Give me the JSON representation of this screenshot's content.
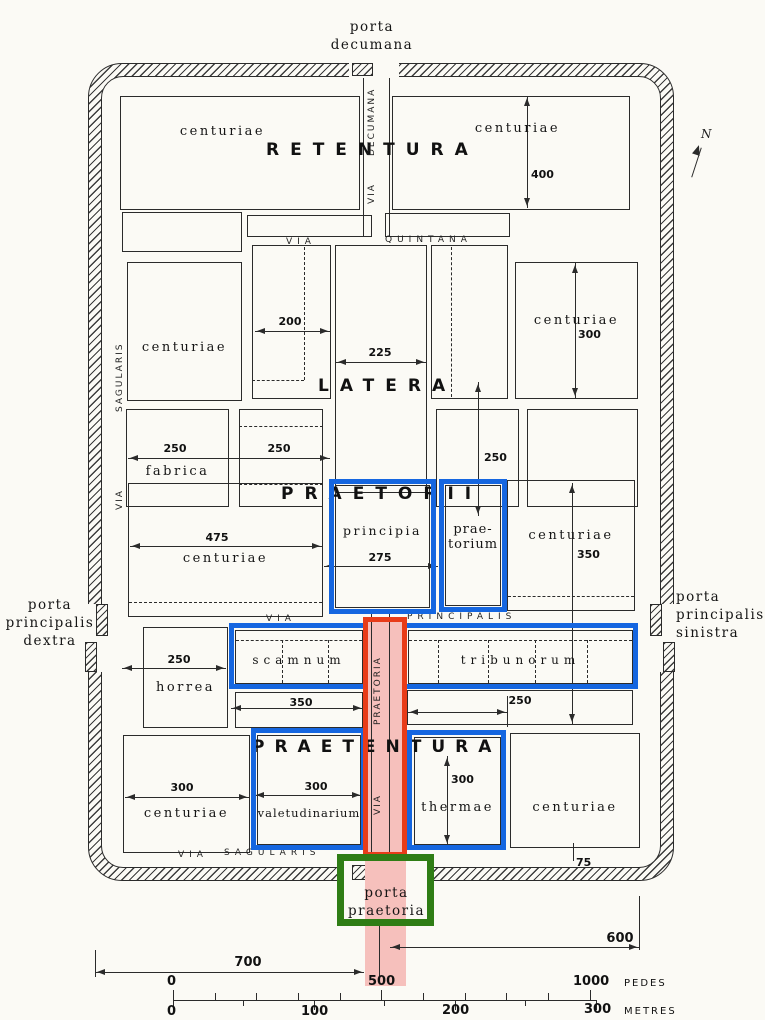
{
  "canvas": {
    "bg": "#fbfaf5"
  },
  "colors": {
    "ink": "#2b2b2b",
    "blue": "#1566e0",
    "red": "#e83c19",
    "green": "#2f7d15",
    "pink": "#f6c0bc"
  },
  "compass": {
    "north": "N"
  },
  "gates": {
    "decumana": {
      "l1": "porta",
      "l2": "decumana"
    },
    "dextra": {
      "l1": "porta",
      "l2": "principalis",
      "l3": "dextra"
    },
    "sinistra": {
      "l1": "porta",
      "l2": "principalis",
      "l3": "sinistra"
    },
    "praetoria": {
      "l1": "porta",
      "l2": "praetoria"
    }
  },
  "sections": {
    "retentura": "RETENTURA",
    "latera": "LATERA",
    "praetorii": "PRAETORII",
    "praetentura": "PRAETENTURA"
  },
  "roads": {
    "decumana": {
      "via": "VIA",
      "name": "DECUMANA"
    },
    "quintana": {
      "via": "VIA",
      "name": "QUINTANA"
    },
    "principalis": {
      "via": "VIA",
      "name": "PRINCIPALIS"
    },
    "praetoria": {
      "via": "VIA",
      "name": "PRAETORIA"
    },
    "sagularis_left": {
      "via": "VIA",
      "name": "SAGULARIS"
    },
    "sagularis_bottom": {
      "via": "VIA",
      "name": "SAGULARIS"
    }
  },
  "buildings": {
    "retentura_centuriae_left": "centuriae",
    "retentura_centuriae_right": "centuriae",
    "latera_centuriae_left": "centuriae",
    "latera_centuriae_right": "centuriae",
    "fabrica": "fabrica",
    "praetorii_centuriae_left": "centuriae",
    "principia": "principia",
    "praetorium_l1": "prae-",
    "praetorium_l2": "torium",
    "praetorii_centuriae_right": "centuriae",
    "horrea": "horrea",
    "scamnum": "scamnum",
    "tribunorum": "tribunorum",
    "praetentura_centuriae_left": "centuriae",
    "valetudinarium": "valetudinarium",
    "thermae": "thermae",
    "praetentura_centuriae_right": "centuriae"
  },
  "dims": {
    "retentura_400": "400",
    "latera_200": "200",
    "latera_225": "225",
    "latera_300": "300",
    "fabrica_250": "250",
    "latera_mid_250": "250",
    "latera_right_250": "250",
    "centuriae_475": "475",
    "principia_275": "275",
    "centuriae_350": "350",
    "horrea_250": "250",
    "scamnum_350": "350",
    "tribunorum_250": "250",
    "praetentura_300_left": "300",
    "valetudinarium_300": "300",
    "thermae_300": "300",
    "rampart_75": "75",
    "south_600": "600",
    "south_700": "700"
  },
  "scalebar": {
    "pedes": {
      "t0": "0",
      "t500": "500",
      "t1000": "1000",
      "unit": "PEDES"
    },
    "metres": {
      "t0": "0",
      "t100": "100",
      "t200": "200",
      "t300": "300",
      "unit": "METRES"
    }
  }
}
